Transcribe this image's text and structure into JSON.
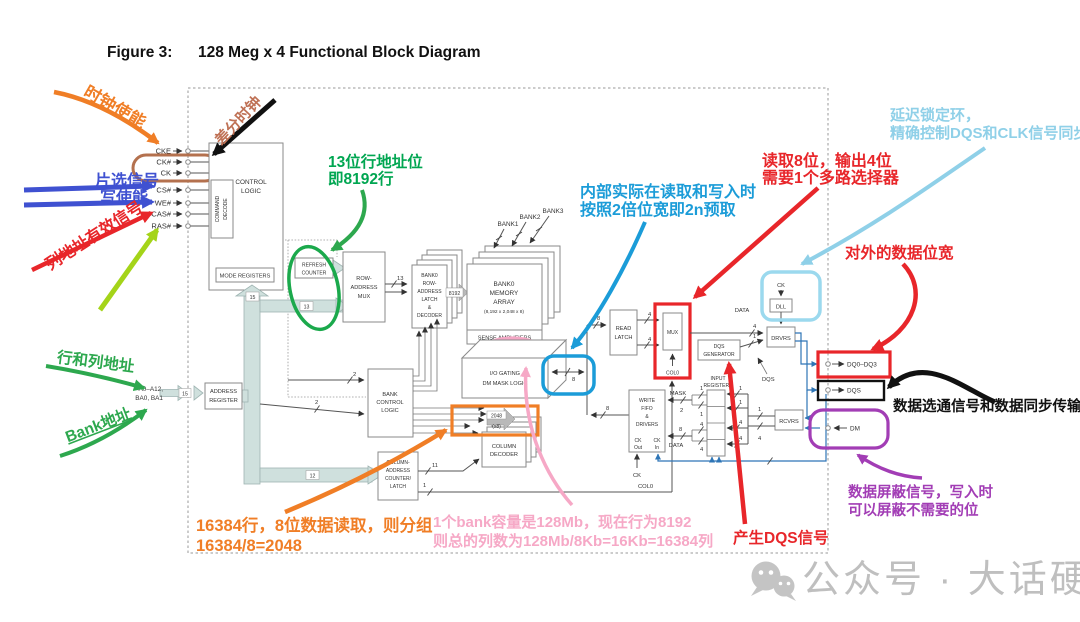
{
  "title": {
    "label": "Figure 3:",
    "text": "128 Meg x 4 Functional Block Diagram"
  },
  "pins_left": [
    "CKE",
    "CK#",
    "CK",
    "CS#",
    "WE#",
    "CAS#",
    "RAS#"
  ],
  "address_pin": {
    "line1": "A0–A12,",
    "line2": "BA0, BA1"
  },
  "pins_right": {
    "dq": "DQ0–DQ3",
    "dqs": "DQS",
    "dm": "DM"
  },
  "blocks": {
    "control_logic": {
      "l1": "CONTROL",
      "l2": "LOGIC"
    },
    "command_decode": {
      "l1": "COMMAND",
      "l2": "DECODE"
    },
    "mode_registers": "MODE REGISTERS",
    "refresh_counter": {
      "l1": "REFRESH",
      "l2": "COUNTER"
    },
    "row_mux": {
      "l1": "ROW-",
      "l2": "ADDRESS",
      "l3": "MUX"
    },
    "bank_latch": {
      "l1": "BANK0",
      "l2": "ROW-",
      "l3": "ADDRESS",
      "l4": "LATCH",
      "l5": "&",
      "l6": "DECODER"
    },
    "memory": {
      "l1": "BANK0",
      "l2": "MEMORY",
      "l3": "ARRAY",
      "l4": "(8,192 x 2,048 x 8)"
    },
    "sense_amps": "SENSE AMPLIFIERS",
    "io_gating": {
      "l1": "I/O GATING",
      "l2": "DM MASK LOGIC"
    },
    "bank_control": {
      "l1": "BANK",
      "l2": "CONTROL",
      "l3": "LOGIC"
    },
    "col_counter": {
      "l1": "COLUMN-",
      "l2": "ADDRESS",
      "l3": "COUNTER/",
      "l4": "LATCH"
    },
    "column_decoder": {
      "l1": "COLUMN",
      "l2": "DECODER"
    },
    "address_register": {
      "l1": "ADDRESS",
      "l2": "REGISTER"
    },
    "read_latch": {
      "l1": "READ",
      "l2": "LATCH"
    },
    "mux": "MUX",
    "col0_mux": "COL0",
    "col0_line": "COL0",
    "dqs_generator": {
      "l1": "DQS",
      "l2": "GENERATOR"
    },
    "write_fifo": {
      "l1": "WRITE",
      "l2": "FIFO",
      "l3": "&",
      "l4": "DRIVERS",
      "ck_out_1": "CK",
      "ck_out_2": "Out",
      "ck_in_1": "CK",
      "ck_in_2": "In"
    },
    "input_registers": {
      "l1": "INPUT",
      "l2": "REGISTERS"
    },
    "drvrs": "DRVRS",
    "rcvrs": "RCVRS",
    "dll": "DLL",
    "ck_dll": "CK",
    "ck_ext": "CK"
  },
  "bank_tags": [
    "BANK1",
    "BANK2",
    "BANK3"
  ],
  "bus": {
    "addr15": "15",
    "up15": "15",
    "b13": "13",
    "row13": "13",
    "b12": "12",
    "two2a": "2",
    "two2b": "2",
    "b11": "11",
    "col1": "1",
    "n8192": "8192",
    "n16384": "16384",
    "n2048": "2048",
    "x8": "(x8)",
    "io8": "8",
    "rl8": "8",
    "wf8": "8",
    "m4a": "4",
    "m4b": "4",
    "out4": "4",
    "data_out": "DATA",
    "gen1": "1",
    "dqs_tag": "DQS",
    "mask": "MASK",
    "mask2": "2",
    "m1a": "1",
    "m1b": "1",
    "d8": "8",
    "d4a": "4",
    "d4b": "4",
    "data_in": "DATA",
    "ir1a": "1",
    "ir1b": "1",
    "ir4a": "4",
    "ir4b": "4",
    "rc1": "1",
    "rc4": "4"
  },
  "annotations": {
    "clock_enable": {
      "text": "时钟使能",
      "color": "#F07E26"
    },
    "diff_clock": {
      "text": "差分时钟",
      "color": "#BF7155"
    },
    "chip_select": {
      "line1": "片选信号",
      "line2": "写使能",
      "color": "#3F51D1"
    },
    "col_valid": {
      "text": "列地址有效信号",
      "color": "#E8262A"
    },
    "row_col": {
      "text": "行和列地址",
      "color": "#2DA84E"
    },
    "bank_addr": {
      "text": "Bank地址",
      "color": "#2DA84E"
    },
    "row_bits": {
      "line1": "13位行地址位",
      "line2": "即8192行",
      "color": "#00A651"
    },
    "prefetch": {
      "line1": "内部实际在读取和写入时",
      "line2": "按照2倍位宽即2n预取",
      "color": "#1B9CD8"
    },
    "mux_note": {
      "line1": "读取8位，输出4位",
      "line2": "需要1个多路选择器",
      "color": "#E8262A"
    },
    "dll_note": {
      "line1": "延迟锁定环，",
      "line2": "精确控制DQS和CLK信号同步",
      "color": "#8FD0E8"
    },
    "width_note": {
      "text": "对外的数据位宽",
      "color": "#E8262A"
    },
    "grouping": {
      "line1": "16384行，8位数据读取，则分组",
      "line2": "16384/8=2048",
      "color": "#F07E26"
    },
    "bank_capacity": {
      "line1": "1个bank容量是128Mb，现在行为8192",
      "line2": "则总的列数为128Mb/8Kb=16Kb=16384列",
      "color": "#F6A8C6"
    },
    "dqs_note": {
      "text": "产生DQS信号",
      "color": "#E8262A"
    },
    "strobe_note": {
      "text": "数据选通信号和数据同步传输",
      "color": "#111111"
    },
    "mask_note": {
      "line1": "数据屏蔽信号，写入时",
      "line2": "可以屏蔽不需要的位",
      "color": "#A23DB5"
    }
  },
  "watermark": {
    "text": "公众号 · 大话硬件"
  }
}
